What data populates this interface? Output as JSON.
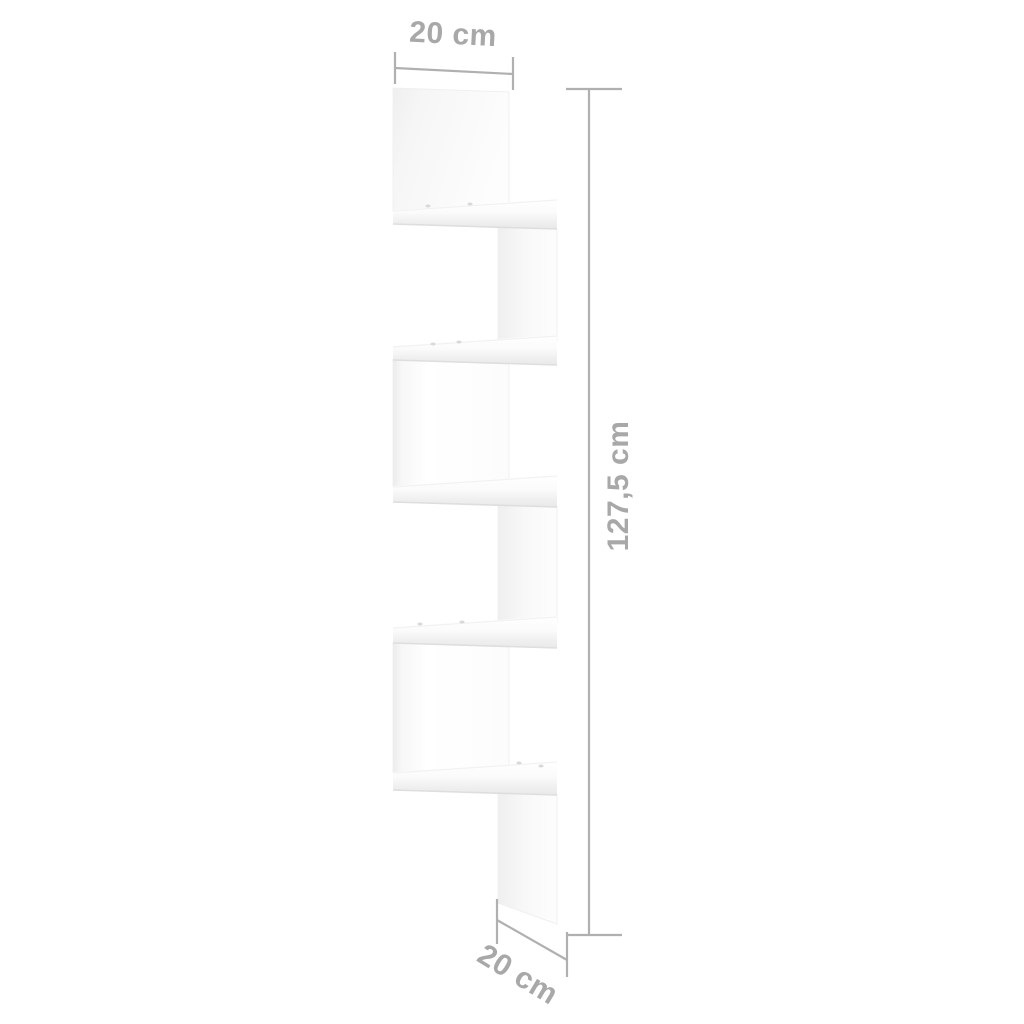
{
  "diagram": {
    "subject": "5-tier zigzag corner wall shelf",
    "dimensions": {
      "top_width": "20 cm",
      "height": "127,5 cm",
      "bottom_depth": "20 cm"
    },
    "colors": {
      "background": "#ffffff",
      "dimension_lines": "#b0b0b0",
      "dimension_text": "#a8a8a8",
      "shelf_white": "#ffffff",
      "shelf_shade": "#ededed",
      "shelf_edge_line": "#dedede"
    }
  }
}
